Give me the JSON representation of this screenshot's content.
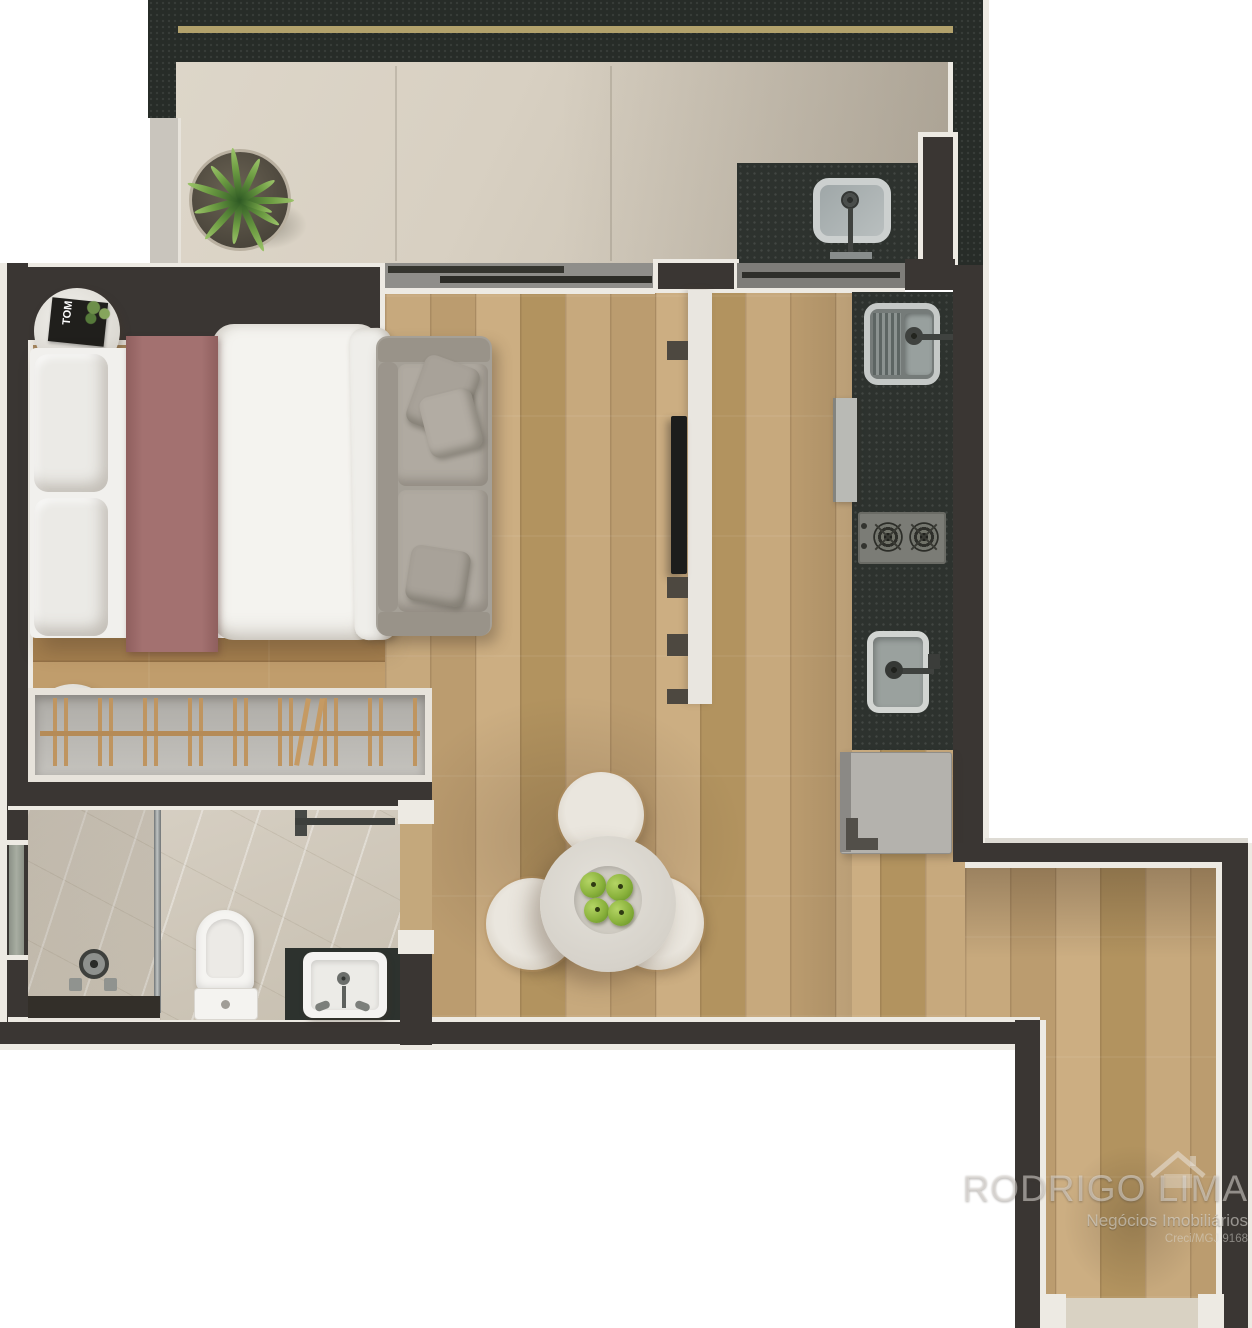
{
  "watermark": {
    "brand": "RODRIGO LIMA",
    "tagline": "Negócios Imobiliários",
    "license": "Creci/MGJ 9168"
  },
  "decor": {
    "magazine_title": "TOM"
  },
  "colors": {
    "wall": "#3a3633",
    "outline": "#edeae3",
    "balcony_granite": "#272c28",
    "gold_trim": "#b3a26c",
    "balcony_tile": "#d8d0c2",
    "counter_granite": "#2d322e",
    "marble": "#d1c9bc",
    "bed_runner": "#a37170",
    "sofa": "#a5a097",
    "apple_green": "#86b23b",
    "fixture_white": "#f2f1ee",
    "glass": "#8b8f8c",
    "wood_living": "#c1a377",
    "wood_bedroom": "#ab8a5c"
  }
}
